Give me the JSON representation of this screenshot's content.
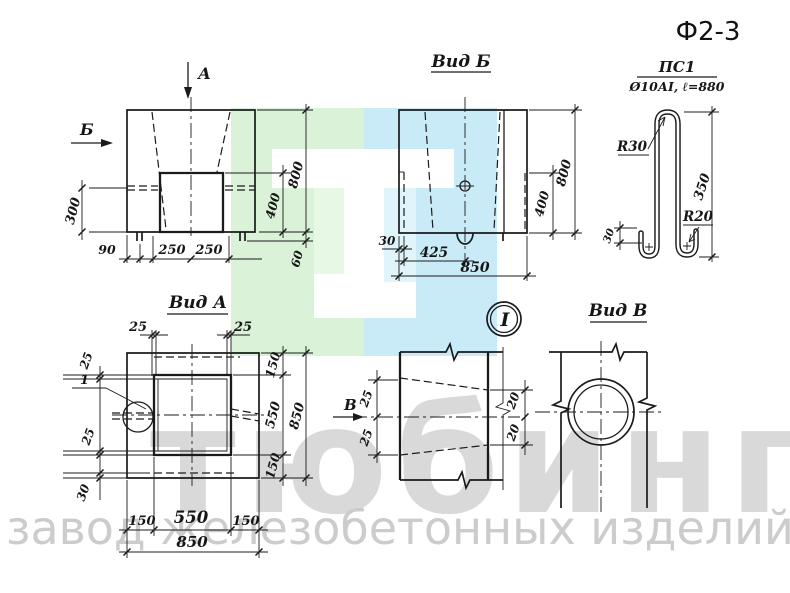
{
  "title": "Ф2-3",
  "watermark": {
    "big_text": "тюбинг",
    "sub_text": "завод железобетонных изделий",
    "green": "#d9f2d8",
    "blue": "#c9ebf7",
    "light_green": "#e7f8e4",
    "light_blue": "#dff4fb",
    "big_color": "#d9d9d9",
    "sub_color": "#cccccc"
  },
  "views": {
    "front": {
      "marker_a": "А",
      "marker_b": "Б",
      "dim_300": "300",
      "dim_90": "90",
      "dim_250_left": "250",
      "dim_250_right": "250",
      "dim_400": "400",
      "dim_800": "800",
      "dim_60": "60"
    },
    "vid_b": {
      "label": "Вид Б",
      "dim_30": "30",
      "dim_425": "425",
      "dim_850": "850",
      "dim_400": "400",
      "dim_800": "800"
    },
    "vid_a": {
      "label": "Вид А",
      "detail_ref": "1",
      "dim_25_top_left": "25",
      "dim_25_top_right": "25",
      "dim_25_left_upper": "25",
      "dim_25_left_lower": "25",
      "dim_30_left": "30",
      "dim_150_right_top": "150",
      "dim_550_right": "550",
      "dim_150_right_bottom": "150",
      "dim_850_right": "850",
      "dim_150_bottom_left": "150",
      "dim_550_bottom": "550",
      "dim_150_bottom_right": "150",
      "dim_850_bottom": "850"
    },
    "detail_i": {
      "balloon": "I",
      "marker_v": "В",
      "dim_25_upper": "25",
      "dim_25_lower": "25",
      "dim_20_upper": "20",
      "dim_20_lower": "20"
    },
    "vid_v": {
      "label": "Вид В"
    },
    "rebar": {
      "mark": "ПС1",
      "spec": "Ø10АI, ℓ=880",
      "radius_top": "R30",
      "radius_bottom": "R20",
      "dim_350": "350",
      "dim_30": "30"
    }
  }
}
